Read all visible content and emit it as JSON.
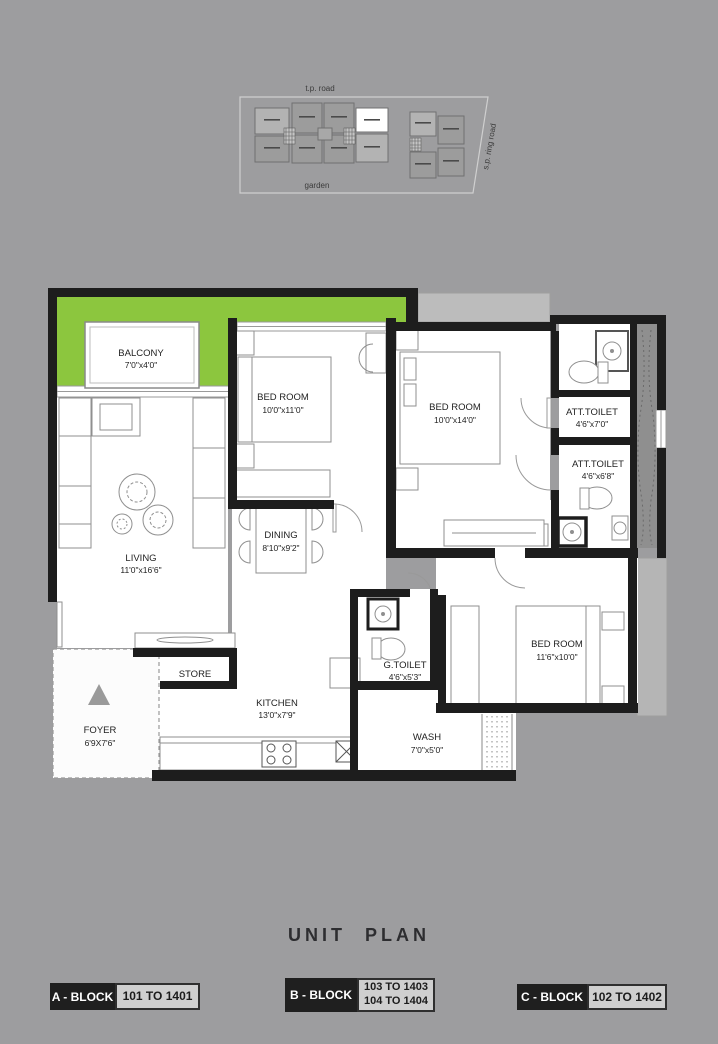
{
  "colors": {
    "background": "#9d9d9f",
    "balcony_green": "#8cc63e",
    "wall_black": "#1d1d1d",
    "exterior_ledge_gray": "#b7b7b7",
    "shaft_gray": "#8f8f8f",
    "legend_value_bg": "#cfcfcf"
  },
  "site_plan": {
    "top_road": "t.p. road",
    "bottom_area": "garden",
    "right_road": "s.p. ring road"
  },
  "unit_plan": {
    "balcony": {
      "name": "BALCONY",
      "dims": "7'0\"x4'0\""
    },
    "bedroom_1": {
      "name": "BED ROOM",
      "dims": "10'0\"x11'0\""
    },
    "bedroom_2": {
      "name": "BED ROOM",
      "dims": "10'0\"x14'0\""
    },
    "att_toilet_1": {
      "name": "ATT.TOILET",
      "dims": "4'6\"x7'0\""
    },
    "att_toilet_2": {
      "name": "ATT.TOILET",
      "dims": "4'6\"x6'8\""
    },
    "living": {
      "name": "LIVING",
      "dims": "11'0\"x16'6\""
    },
    "dining": {
      "name": "DINING",
      "dims": "8'10\"x9'2\""
    },
    "bedroom_3": {
      "name": "BED ROOM",
      "dims": "11'6\"x10'0\""
    },
    "g_toilet": {
      "name": "G.TOILET",
      "dims": "4'6\"x5'3\""
    },
    "store": {
      "name": "STORE"
    },
    "kitchen": {
      "name": "KITCHEN",
      "dims": "13'0\"x7'9\""
    },
    "wash": {
      "name": "WASH",
      "dims": "7'0\"x5'0\""
    },
    "foyer": {
      "name": "FOYER",
      "dims": "6'9X7'6\""
    }
  },
  "title": "UNIT PLAN",
  "legend": [
    {
      "block": "A - BLOCK",
      "units": [
        "101 TO 1401"
      ]
    },
    {
      "block": "B - BLOCK",
      "units": [
        "103 TO 1403",
        "104 TO 1404"
      ]
    },
    {
      "block": "C - BLOCK",
      "units": [
        "102 TO 1402"
      ]
    }
  ]
}
